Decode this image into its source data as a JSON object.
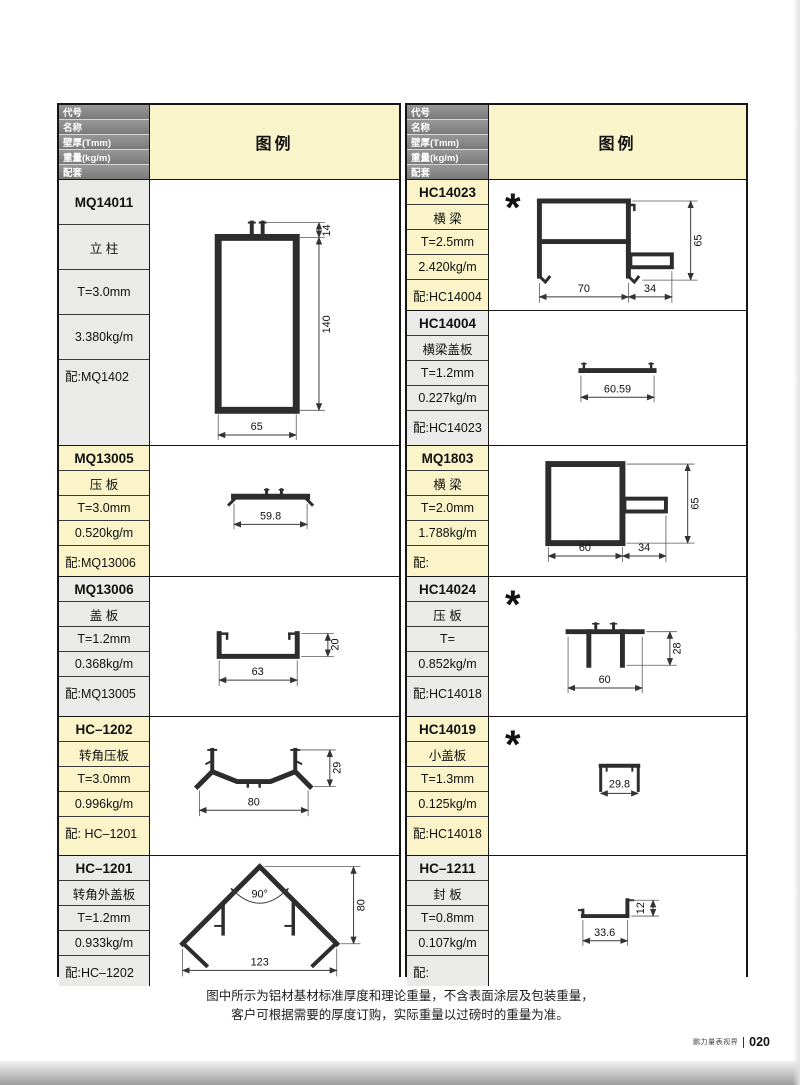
{
  "header": {
    "rows": [
      "代号",
      "名称",
      "壁厚(Tmm)",
      "重量(kg/m)",
      "配套"
    ],
    "legend_label": "图例"
  },
  "marks": {
    "asterisk": "*"
  },
  "columns": {
    "left": {
      "blocks": [
        {
          "code": "MQ14011",
          "name": "立 柱",
          "thickness": "T=3.0mm",
          "weight": "3.380kg/m",
          "match": "配:MQ1402",
          "dims": {
            "top": "14",
            "height": "140",
            "width": "65"
          }
        },
        {
          "code": "MQ13005",
          "name": "压 板",
          "thickness": "T=3.0mm",
          "weight": "0.520kg/m",
          "match": "配:MQ13006",
          "dims": {
            "width": "59.8"
          }
        },
        {
          "code": "MQ13006",
          "name": "盖 板",
          "thickness": "T=1.2mm",
          "weight": "0.368kg/m",
          "match": "配:MQ13005",
          "dims": {
            "width": "63",
            "height": "20"
          }
        },
        {
          "code": "HC–1202",
          "name": "转角压板",
          "thickness": "T=3.0mm",
          "weight": "0.996kg/m",
          "match": "配: HC–1201",
          "dims": {
            "width": "80",
            "height": "29"
          }
        },
        {
          "code": "HC–1201",
          "name": "转角外盖板",
          "thickness": "T=1.2mm",
          "weight": "0.933kg/m",
          "match": "配:HC–1202",
          "dims": {
            "width": "123",
            "height": "80",
            "angle": "90°"
          }
        }
      ]
    },
    "right": {
      "blocks": [
        {
          "code": "HC14023",
          "name": "横 梁",
          "thickness": "T=2.5mm",
          "weight": "2.420kg/m",
          "match": "配:HC14004",
          "dims": {
            "width1": "70",
            "width2": "34",
            "height": "65"
          }
        },
        {
          "code": "HC14004",
          "name": "横梁盖板",
          "thickness": "T=1.2mm",
          "weight": "0.227kg/m",
          "match": "配:HC14023",
          "dims": {
            "width": "60.59"
          }
        },
        {
          "code": "MQ1803",
          "name": "横 梁",
          "thickness": "T=2.0mm",
          "weight": "1.788kg/m",
          "match": "配:",
          "dims": {
            "width1": "60",
            "width2": "34",
            "height": "65"
          }
        },
        {
          "code": "HC14024",
          "name": "压 板",
          "thickness": "T=",
          "weight": "0.852kg/m",
          "match": "配:HC14018",
          "dims": {
            "width": "60",
            "height": "28"
          }
        },
        {
          "code": "HC14019",
          "name": "小盖板",
          "thickness": "T=1.3mm",
          "weight": "0.125kg/m",
          "match": "配:HC14018",
          "dims": {
            "width": "29.8"
          }
        },
        {
          "code": "HC–1211",
          "name": "封 板",
          "thickness": "T=0.8mm",
          "weight": "0.107kg/m",
          "match": "配:",
          "dims": {
            "width": "33.6",
            "height": "12"
          }
        }
      ]
    }
  },
  "footer": {
    "note_line1": "图中所示为铝材基材标准厚度和理论重量，不含表面涂层及包装重量，",
    "note_line2": "客户可根据需要的厚度订购，实际重量以过磅时的重量为准。",
    "brand": "鹏力量表视界",
    "page_number": "020"
  }
}
